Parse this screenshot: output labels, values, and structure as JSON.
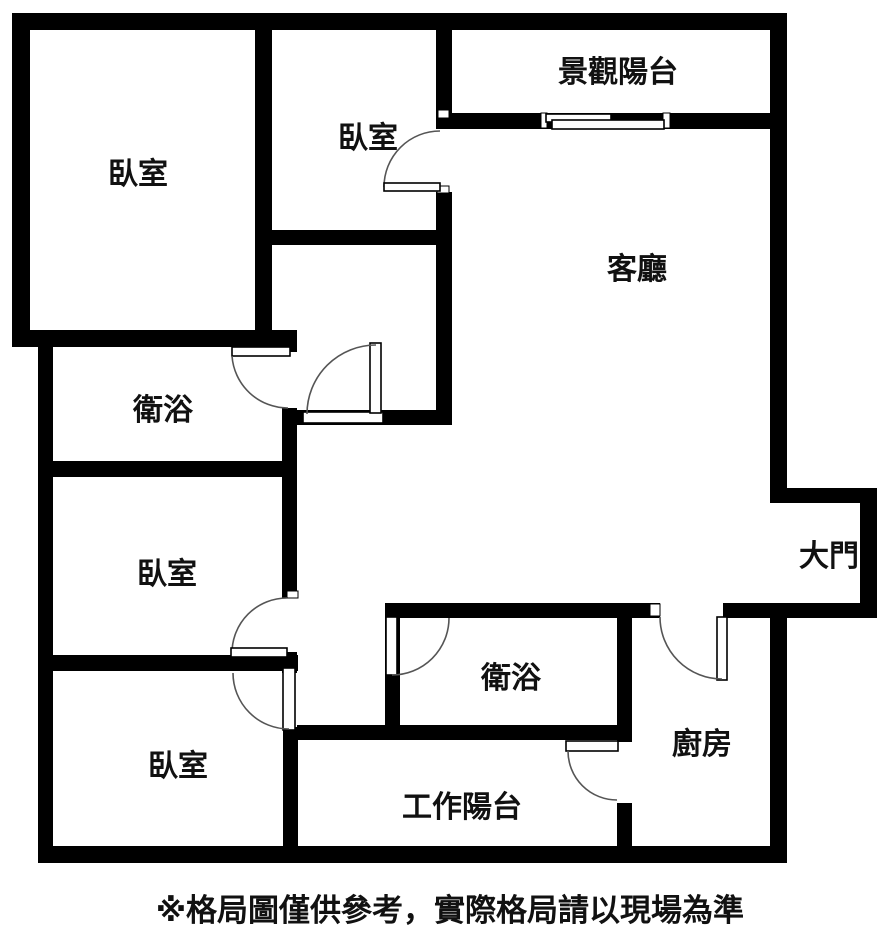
{
  "page": {
    "type": "apartment-floor-plan"
  },
  "rooms": {
    "bedroom_top_left": {
      "label": "臥室"
    },
    "bedroom_top_middle": {
      "label": "臥室"
    },
    "scenic_balcony": {
      "label": "景觀陽台"
    },
    "living_room": {
      "label": "客廳"
    },
    "bathroom_upper": {
      "label": "衛浴"
    },
    "bedroom_middle_left": {
      "label": "臥室"
    },
    "main_door": {
      "label": "大門"
    },
    "bedroom_bottom_left": {
      "label": "臥室"
    },
    "bathroom_lower": {
      "label": "衛浴"
    },
    "work_balcony": {
      "label": "工作陽台"
    },
    "kitchen": {
      "label": "廚房"
    }
  },
  "footer": {
    "disclaimer": "※格局圖僅供參考，實際格局請以現場為準"
  },
  "colors": {
    "wall": "#000000",
    "background": "#ffffff",
    "text": "#111111",
    "door_arc": "#555555"
  }
}
